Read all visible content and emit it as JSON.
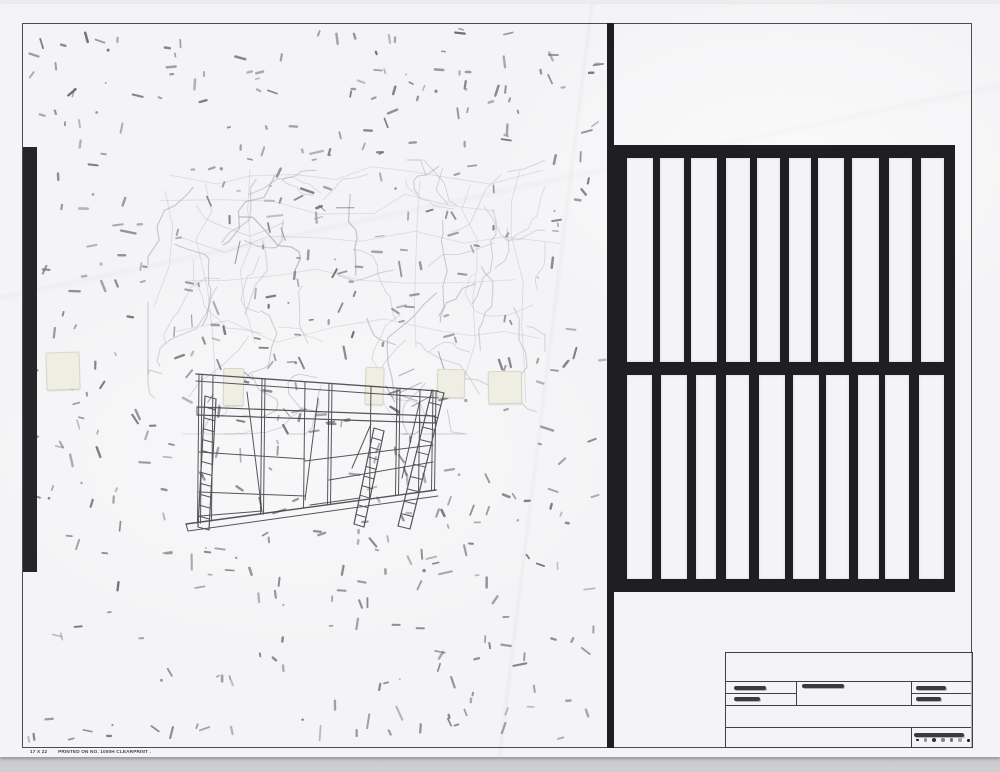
{
  "footer": {
    "size_label": "17 X 22",
    "print_label": "PRINTED ON NO. 1000H CLEARPRINT ."
  },
  "colors": {
    "tape_black": "#1f1f23",
    "border_line": "#4b4b55",
    "paper": "#f4f4f6",
    "pencil_mark": "#7c7c88",
    "faint_sketch": "#a6a6b3",
    "scaffold_ink": "#3e3e46",
    "backdrop": "#e4e4e6"
  },
  "artwork": {
    "grid": {
      "rows": 2,
      "columns": 10
    },
    "marks": {
      "count": 440,
      "dot_count": 30,
      "seed": 7
    },
    "sketch": {
      "crack_count": 60,
      "accent_count": 16,
      "seed": 11
    },
    "tape_patch_count": 5
  },
  "title_block": {
    "redactions": {
      "left_top_w": 32,
      "left_bottom_w": 26,
      "middle_w": 42,
      "right_top_w": 30,
      "right_bottom_w": 25,
      "bottom_w": 50
    },
    "dots": [
      {
        "color": "#141416",
        "size": 2.8
      },
      {
        "color": "#8f8f97",
        "size": 3.6
      },
      {
        "color": "#2f2f33",
        "size": 4.0
      },
      {
        "color": "#85858d",
        "size": 3.4
      },
      {
        "color": "#6f6f77",
        "size": 3.6
      },
      {
        "color": "#a2a2a8",
        "size": 3.2
      },
      {
        "color": "#141416",
        "size": 3.0
      }
    ]
  }
}
